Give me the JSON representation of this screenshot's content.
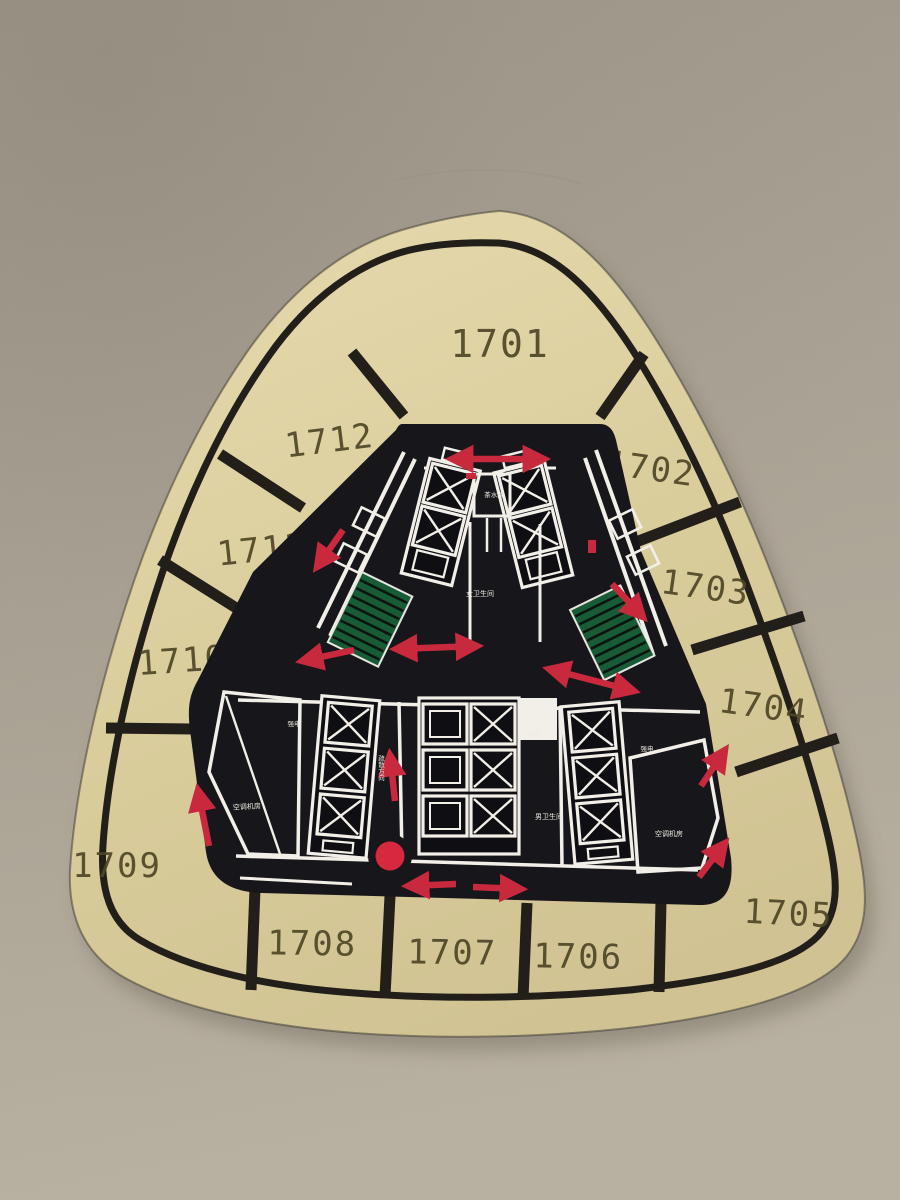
{
  "sign": {
    "description_labels": {
      "floor_prefix": "17"
    },
    "rooms": [
      {
        "number": "1701"
      },
      {
        "number": "1702"
      },
      {
        "number": "1703"
      },
      {
        "number": "1704"
      },
      {
        "number": "1705"
      },
      {
        "number": "1706"
      },
      {
        "number": "1707"
      },
      {
        "number": "1708"
      },
      {
        "number": "1709"
      },
      {
        "number": "1710"
      },
      {
        "number": "1711"
      },
      {
        "number": "1712"
      }
    ],
    "core_labels": {
      "tea_room": "茶水间",
      "women_restroom": "女卫生间",
      "men_restroom": "男卫生间",
      "weak_electric": "弱电",
      "strong_electric_left": "强电",
      "strong_electric_right": "强电",
      "ac_room_left": "空调机房",
      "ac_room_right": "空调机房",
      "evac_direction": "疏散方向"
    },
    "colors": {
      "wall": "#aba496",
      "sign_face": "#ddd1a2",
      "core_black": "#17161a",
      "trim_black": "#221f1b",
      "room_number": "#4e4626",
      "evac_red": "#c9293d",
      "stair_green": "#175c36",
      "plan_white": "#f2efe8"
    }
  }
}
